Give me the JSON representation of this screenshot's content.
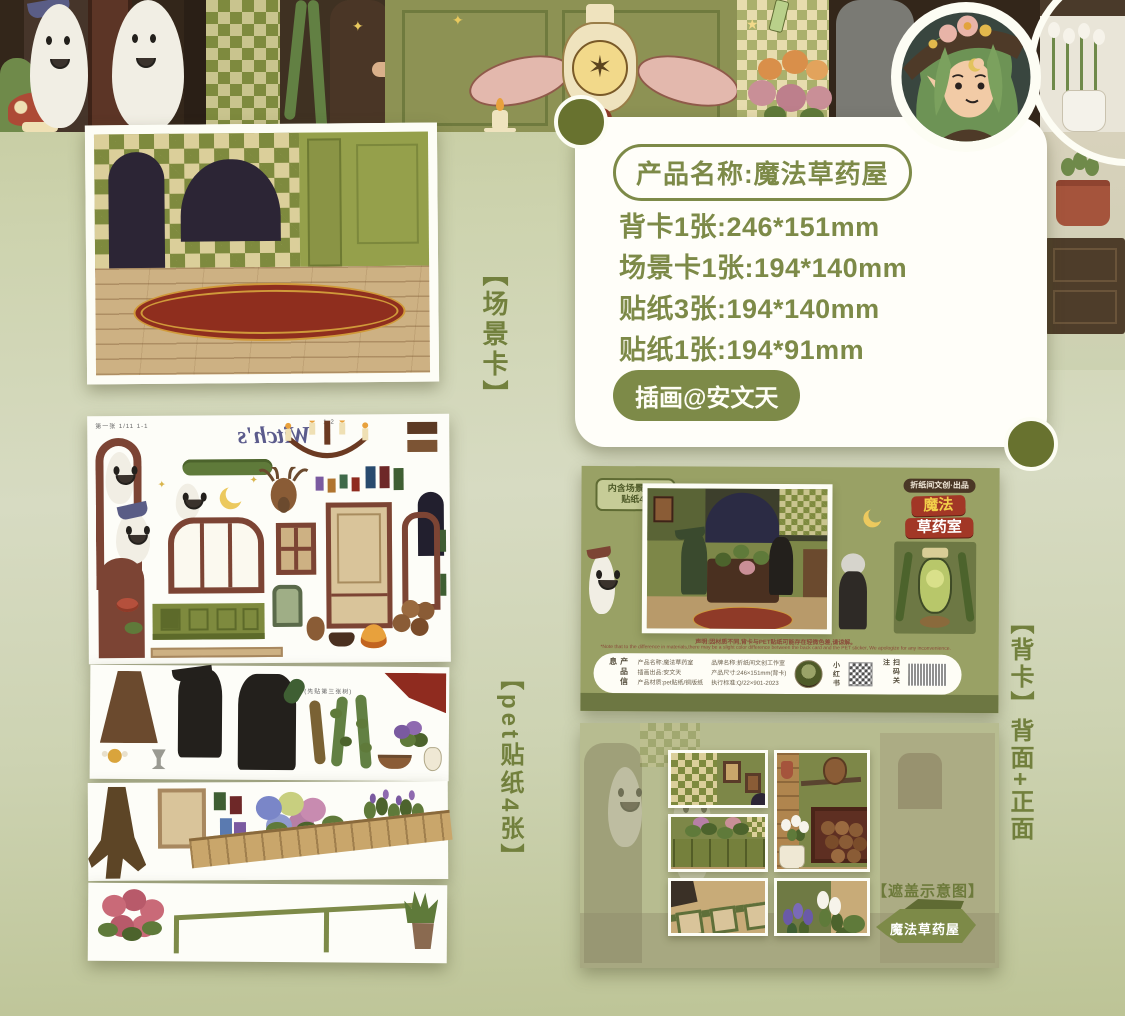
{
  "colors": {
    "accent": "#7d8a48",
    "back_card_bg": "#99a165",
    "title_red": "#a23726",
    "title_yellow": "#f2cf4a"
  },
  "info_card": {
    "product_name": "产品名称:魔法草药屋",
    "specs": [
      "背卡1张:246*151mm",
      "场景卡1张:194*140mm",
      "贴纸3张:194*140mm",
      "贴纸1张:194*91mm"
    ],
    "illustrator": "插画@安文天"
  },
  "side_labels": {
    "scene_card": "【场景卡】",
    "pet_stickers": "【pet贴纸4张】",
    "back_card": "【背卡】背面+正面"
  },
  "sheet1": {
    "header_left": "第一张 1/11 1-1",
    "header_right": "1-2",
    "script_text": "Witch's"
  },
  "sheet2": {
    "note": "(先贴第三张树)"
  },
  "back_card": {
    "bubble_line1": "内含场景卡1p",
    "bubble_line2": "贴纸4p",
    "publisher": "折纸间文创·出品",
    "title_top": "魔法",
    "title_bottom": "草药室",
    "disclaimer_cn": "声明:因材质不同,背卡与PET贴纸可能存在轻微色差,请谅解。",
    "disclaimer_en": "*Note that to the difference in materials,there may be a slight color difference between the back card and the PET sticker, We apologize for any inconvenience.",
    "info_label": "产品信息",
    "info_col1": [
      "产品名称:魔法草药室",
      "插画出品:安文天",
      "产品材质:pet贴纸/铜版纸"
    ],
    "info_col2": [
      "品牌名称:折纸间文创工作室",
      "产品尺寸:246×151mm(背卡)",
      "执行标准:Q/22×901-2023"
    ],
    "xhs_label": "小红书",
    "scan_label": "扫码关注"
  },
  "front_panel": {
    "caption": "【遮盖示意图】",
    "ribbon": "魔法草药屋"
  }
}
